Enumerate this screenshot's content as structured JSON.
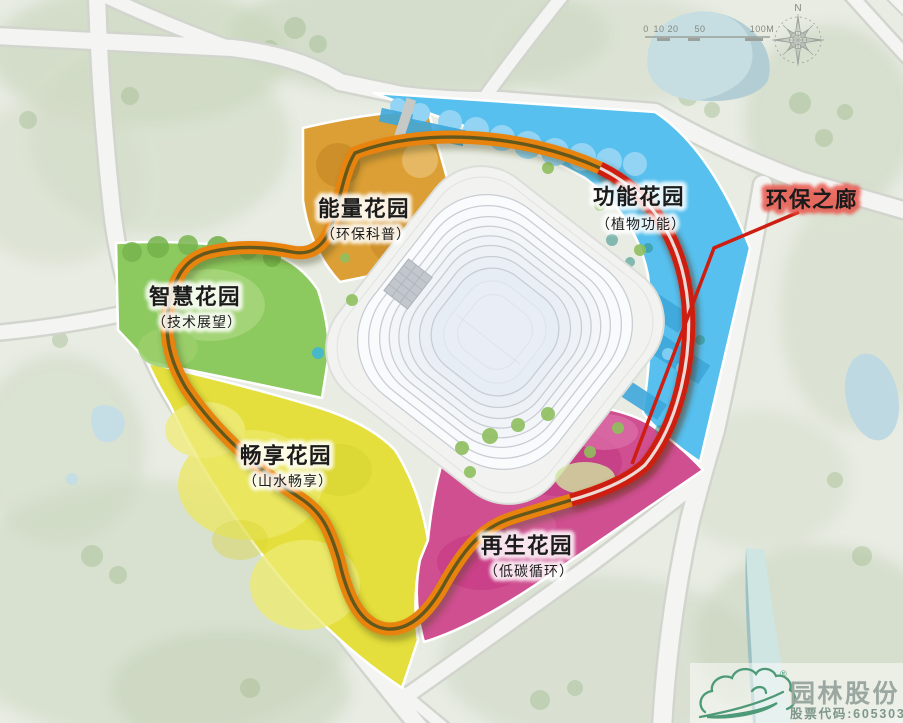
{
  "map": {
    "gardens": [
      {
        "name": "能量花园",
        "sub": "（环保科普）",
        "theme": "环保科普",
        "color": "#dc9f35"
      },
      {
        "name": "智慧花园",
        "sub": "（技术展望）",
        "theme": "技术展望",
        "color": "#8cc95e"
      },
      {
        "name": "畅享花园",
        "sub": "（山水畅享）",
        "theme": "山水畅享",
        "color": "#e4df3c"
      },
      {
        "name": "再生花园",
        "sub": "（低碳循环）",
        "theme": "低碳循环",
        "color": "#cf4f90"
      },
      {
        "name": "功能花园",
        "sub": "（植物功能）",
        "theme": "植物功能",
        "color": "#57c0ee"
      }
    ],
    "corridor": {
      "label": "环保之廊",
      "ribbon_orange": "#e8830e",
      "ribbon_red": "#ce1d11"
    }
  },
  "compass": {
    "north_label": "N"
  },
  "scale_bar": {
    "tick_labels": [
      "0",
      "10",
      "20",
      "50",
      "100M"
    ]
  },
  "logo": {
    "company": "园林股份",
    "stock_code_label": "股票代码:605303",
    "registered_mark": "®",
    "brand_green": "#4e9a78"
  }
}
